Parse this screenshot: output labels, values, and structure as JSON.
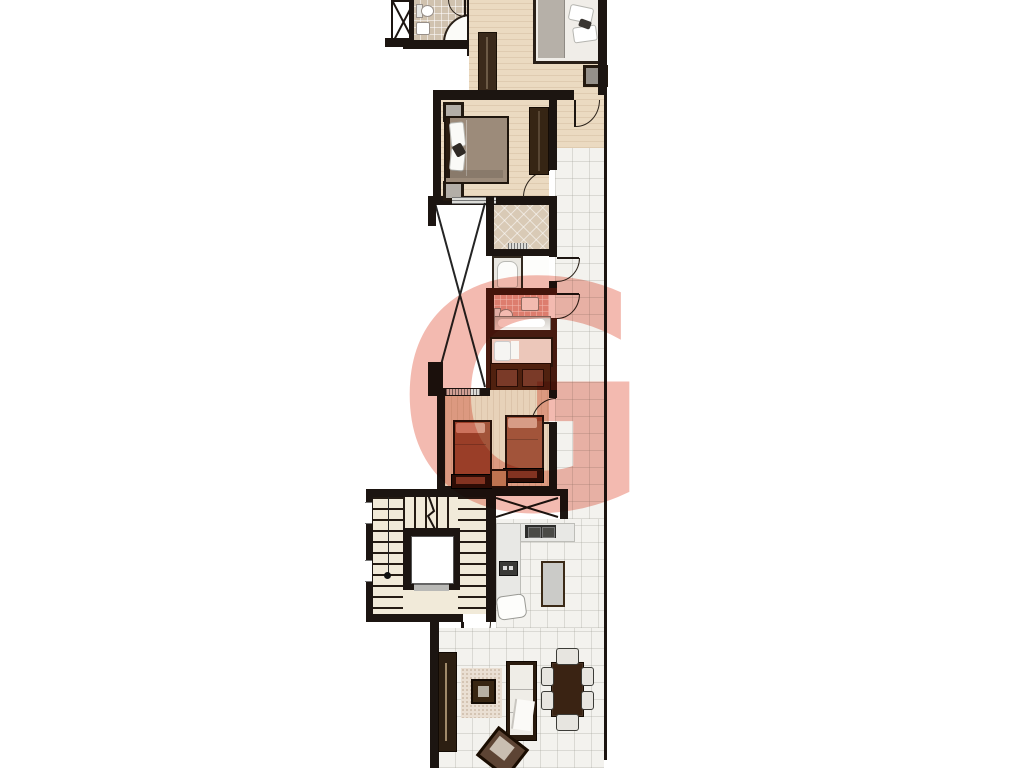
{
  "watermark": {
    "letter": "G",
    "color": "#f2b4a9"
  },
  "palette": {
    "wall": "#1c1511",
    "bathroom_wall_maroon": "#471b10",
    "wood_floor": "#ebdac1",
    "wood_floor_dark": "#e7d2b9",
    "tile_floor": "#f3f2ee",
    "bath_tile_tan": "#d0c2af",
    "bath_tile_pink": "#e8aca0",
    "stair_floor": "#f1ead9",
    "kitchen_counter": "#e8e8e5",
    "dark_wood_furniture": "#2c1f12",
    "master_bed_blanket": "#b6b0a8",
    "double_bed_blanket": "#9c8b7a",
    "twin_bed_blanket": "#a2543a"
  }
}
